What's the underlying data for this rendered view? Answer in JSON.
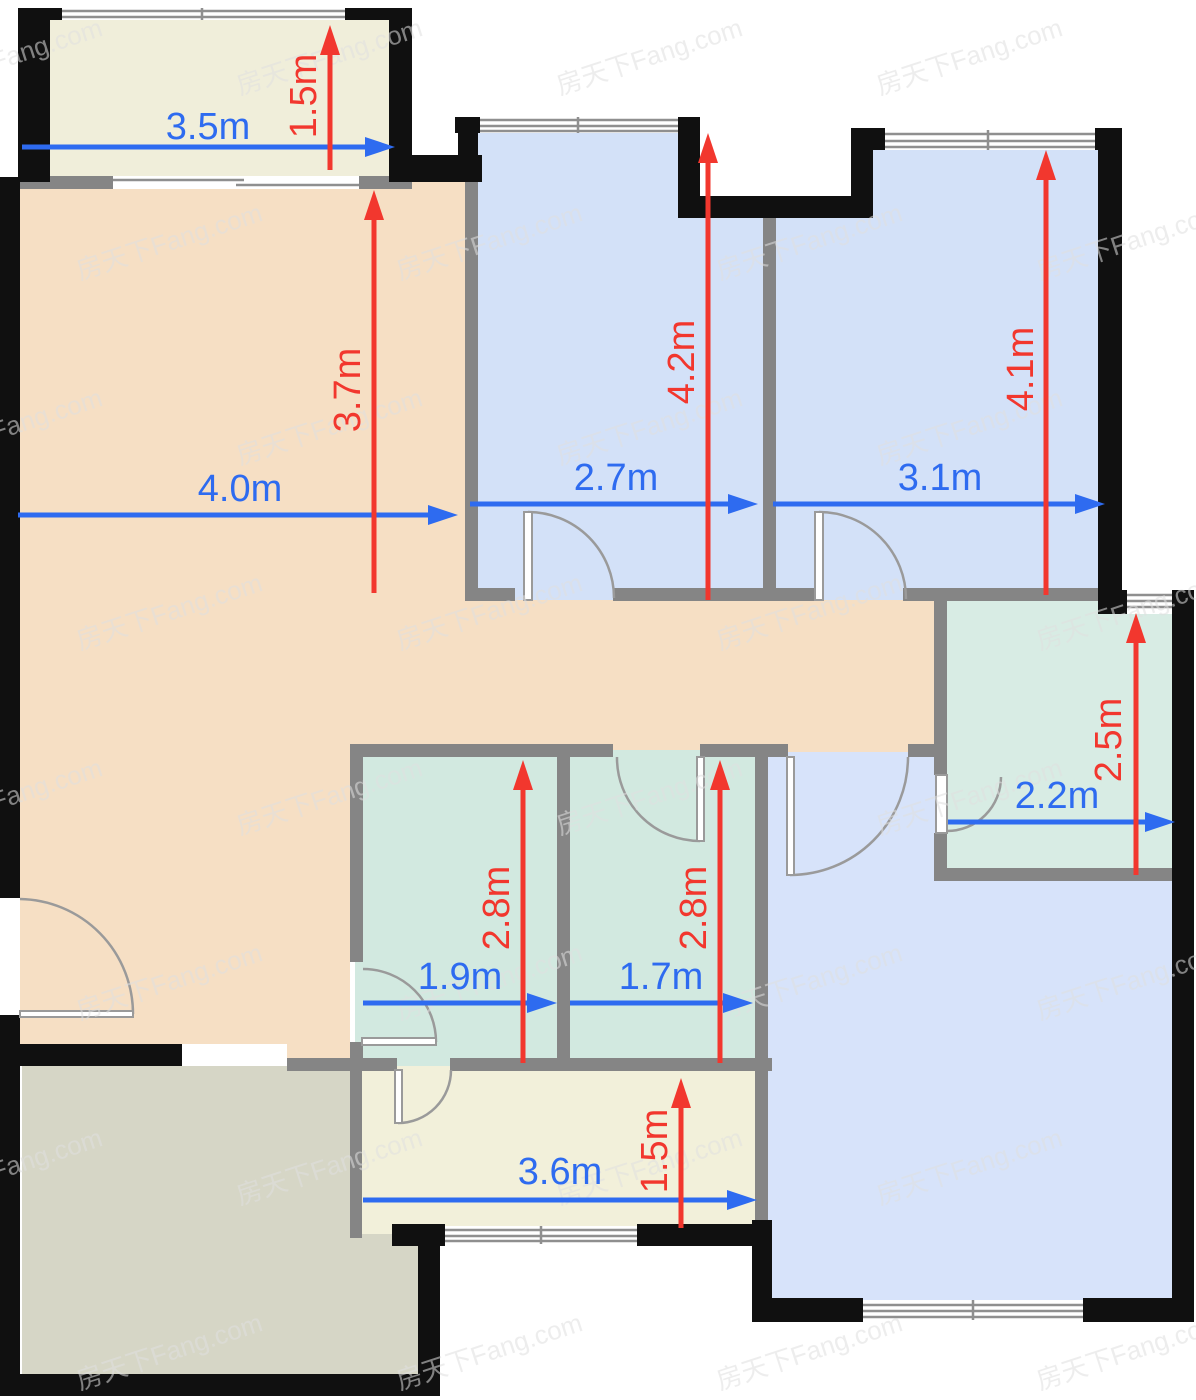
{
  "watermark": {
    "text": "房天下Fang.com"
  },
  "palette": {
    "wall_black": "#101010",
    "wall_gray": "#858585",
    "balcony": "#f0eeda",
    "living": "#f6dfc4",
    "bedroom_blue": "#d3e1f8",
    "bedroom_blue2": "#d7e3fa",
    "bath_teal": "#d2e9e0",
    "bath_teal2": "#d8ece4",
    "kitchen": "#f2f0da",
    "terrace": "#d6d6c6",
    "dim_blue": "#2e6bf0",
    "dim_red": "#f2372e",
    "door_stroke": "#9a9a9a",
    "window_line": "#8f8f8f",
    "watermark_fill": "#e0e0e0"
  },
  "rooms": [
    {
      "name": "balcony",
      "color": "balcony",
      "x": 18,
      "y": 12,
      "w": 392,
      "h": 170
    },
    {
      "name": "living-room-upper",
      "color": "living",
      "x": 20,
      "y": 177,
      "w": 445,
      "h": 423
    },
    {
      "name": "hallway",
      "color": "living",
      "x": 20,
      "y": 600,
      "w": 914,
      "h": 156
    },
    {
      "name": "living-room-lower",
      "color": "living",
      "x": 20,
      "y": 756,
      "w": 330,
      "h": 310
    },
    {
      "name": "bedroom-top-middle",
      "color": "bedroom_blue",
      "x": 478,
      "y": 125,
      "w": 285,
      "h": 475
    },
    {
      "name": "bedroom-top-right",
      "color": "bedroom_blue",
      "x": 776,
      "y": 140,
      "w": 322,
      "h": 460
    },
    {
      "name": "bedroom-bottom-right",
      "color": "bedroom_blue2",
      "x": 767,
      "y": 752,
      "w": 413,
      "h": 552
    },
    {
      "name": "bathroom-right",
      "color": "bath_teal2",
      "x": 940,
      "y": 600,
      "w": 240,
      "h": 275
    },
    {
      "name": "bathroom-left",
      "color": "bath_teal",
      "x": 355,
      "y": 750,
      "w": 208,
      "h": 316
    },
    {
      "name": "bathroom-middle",
      "color": "bath_teal",
      "x": 563,
      "y": 750,
      "w": 199,
      "h": 316
    },
    {
      "name": "kitchen",
      "color": "kitchen",
      "x": 355,
      "y": 1066,
      "w": 407,
      "h": 168
    },
    {
      "name": "terrace-upper",
      "color": "terrace",
      "x": 22,
      "y": 1066,
      "w": 333,
      "h": 310
    },
    {
      "name": "terrace-lower",
      "color": "terrace",
      "x": 355,
      "y": 1234,
      "w": 75,
      "h": 142
    }
  ],
  "white_patches": [
    {
      "name": "exterior-notch",
      "x": 678,
      "y": 60,
      "w": 195,
      "h": 136
    },
    {
      "name": "living-terrace-opening",
      "x": 182,
      "y": 1044,
      "w": 105,
      "h": 22
    }
  ],
  "walls_black": [
    {
      "x": 18,
      "y": 8,
      "w": 44,
      "h": 12
    },
    {
      "x": 345,
      "y": 8,
      "w": 67,
      "h": 12
    },
    {
      "x": 18,
      "y": 8,
      "w": 32,
      "h": 174
    },
    {
      "x": 389,
      "y": 8,
      "w": 23,
      "h": 150
    },
    {
      "x": 389,
      "y": 155,
      "w": 93,
      "h": 27
    },
    {
      "x": 0,
      "y": 177,
      "w": 20,
      "h": 721
    },
    {
      "x": 0,
      "y": 1015,
      "w": 20,
      "h": 381
    },
    {
      "x": 0,
      "y": 1374,
      "w": 440,
      "h": 22
    },
    {
      "x": 418,
      "y": 1234,
      "w": 22,
      "h": 162
    },
    {
      "x": 0,
      "y": 1044,
      "w": 182,
      "h": 22
    },
    {
      "x": 455,
      "y": 117,
      "w": 25,
      "h": 16
    },
    {
      "x": 458,
      "y": 117,
      "w": 20,
      "h": 65
    },
    {
      "x": 678,
      "y": 117,
      "w": 22,
      "h": 101
    },
    {
      "x": 678,
      "y": 196,
      "w": 195,
      "h": 22
    },
    {
      "x": 851,
      "y": 128,
      "w": 22,
      "h": 90
    },
    {
      "x": 851,
      "y": 128,
      "w": 34,
      "h": 22
    },
    {
      "x": 1095,
      "y": 128,
      "w": 27,
      "h": 22
    },
    {
      "x": 1098,
      "y": 128,
      "w": 24,
      "h": 476
    },
    {
      "x": 1098,
      "y": 590,
      "w": 31,
      "h": 24
    },
    {
      "x": 1170,
      "y": 590,
      "w": 24,
      "h": 24
    },
    {
      "x": 1172,
      "y": 600,
      "w": 22,
      "h": 722
    },
    {
      "x": 752,
      "y": 1298,
      "w": 111,
      "h": 24
    },
    {
      "x": 1083,
      "y": 1298,
      "w": 111,
      "h": 24
    },
    {
      "x": 752,
      "y": 1220,
      "w": 20,
      "h": 102
    },
    {
      "x": 392,
      "y": 1224,
      "w": 53,
      "h": 22
    },
    {
      "x": 637,
      "y": 1224,
      "w": 135,
      "h": 22
    }
  ],
  "walls_gray": [
    {
      "x": 20,
      "y": 176,
      "w": 95,
      "h": 13
    },
    {
      "x": 357,
      "y": 176,
      "w": 55,
      "h": 13
    },
    {
      "x": 465,
      "y": 180,
      "w": 13,
      "h": 420
    },
    {
      "x": 465,
      "y": 588,
      "w": 50,
      "h": 13
    },
    {
      "x": 613,
      "y": 588,
      "w": 204,
      "h": 13
    },
    {
      "x": 903,
      "y": 588,
      "w": 195,
      "h": 13
    },
    {
      "x": 763,
      "y": 196,
      "w": 13,
      "h": 404
    },
    {
      "x": 934,
      "y": 600,
      "w": 13,
      "h": 175
    },
    {
      "x": 934,
      "y": 833,
      "w": 13,
      "h": 47
    },
    {
      "x": 934,
      "y": 868,
      "w": 246,
      "h": 13
    },
    {
      "x": 350,
      "y": 744,
      "w": 263,
      "h": 13
    },
    {
      "x": 700,
      "y": 744,
      "w": 67,
      "h": 13
    },
    {
      "x": 767,
      "y": 744,
      "w": 21,
      "h": 13
    },
    {
      "x": 908,
      "y": 744,
      "w": 32,
      "h": 13
    },
    {
      "x": 350,
      "y": 744,
      "w": 13,
      "h": 218
    },
    {
      "x": 350,
      "y": 1042,
      "w": 13,
      "h": 24
    },
    {
      "x": 557,
      "y": 750,
      "w": 13,
      "h": 316
    },
    {
      "x": 755,
      "y": 750,
      "w": 13,
      "h": 470
    },
    {
      "x": 287,
      "y": 1058,
      "w": 110,
      "h": 13
    },
    {
      "x": 450,
      "y": 1058,
      "w": 322,
      "h": 13
    },
    {
      "x": 350,
      "y": 1058,
      "w": 12,
      "h": 180
    }
  ],
  "windows": [
    {
      "name": "balcony-window",
      "base": {
        "x": 62,
        "y": 8,
        "w": 283,
        "h": 12
      },
      "lines": [
        [
          62,
          11,
          345,
          11
        ],
        [
          62,
          17,
          345,
          17
        ],
        [
          202,
          8,
          202,
          20
        ]
      ]
    },
    {
      "name": "bedroom-top-middle-window",
      "base": {
        "x": 480,
        "y": 117,
        "w": 198,
        "h": 16
      },
      "lines": [
        [
          480,
          120,
          678,
          120
        ],
        [
          480,
          126,
          678,
          126
        ],
        [
          480,
          131,
          678,
          131
        ],
        [
          578,
          117,
          578,
          133
        ]
      ]
    },
    {
      "name": "bedroom-top-right-window",
      "base": {
        "x": 885,
        "y": 130,
        "w": 210,
        "h": 20
      },
      "lines": [
        [
          885,
          134,
          1095,
          134
        ],
        [
          885,
          141,
          1095,
          141
        ],
        [
          885,
          147,
          1095,
          147
        ],
        [
          988,
          130,
          988,
          150
        ]
      ]
    },
    {
      "name": "bathroom-right-window",
      "base": {
        "x": 1127,
        "y": 590,
        "w": 45,
        "h": 24
      },
      "lines": [
        [
          1127,
          595,
          1172,
          595
        ],
        [
          1127,
          601,
          1172,
          601
        ],
        [
          1127,
          607,
          1172,
          607
        ]
      ]
    },
    {
      "name": "kitchen-window",
      "base": {
        "x": 445,
        "y": 1226,
        "w": 192,
        "h": 18
      },
      "lines": [
        [
          445,
          1230,
          637,
          1230
        ],
        [
          445,
          1236,
          637,
          1236
        ],
        [
          445,
          1241,
          637,
          1241
        ],
        [
          541,
          1226,
          541,
          1244
        ]
      ]
    },
    {
      "name": "bedroom-bottom-right-window",
      "base": {
        "x": 863,
        "y": 1300,
        "w": 220,
        "h": 20
      },
      "lines": [
        [
          863,
          1305,
          1083,
          1305
        ],
        [
          863,
          1311,
          1083,
          1311
        ],
        [
          863,
          1317,
          1083,
          1317
        ],
        [
          973,
          1300,
          973,
          1320
        ]
      ]
    },
    {
      "name": "balcony-sliding-door",
      "base": {
        "x": 113,
        "y": 176,
        "w": 246,
        "h": 13
      },
      "lines": [
        [
          113,
          180,
          244,
          180
        ],
        [
          236,
          185,
          359,
          185
        ]
      ]
    }
  ],
  "doors": [
    {
      "name": "entry-door",
      "leaf": {
        "x": 20,
        "y": 1011,
        "w": 113,
        "h": 6
      },
      "arc": "M 20 899 A 115 115 0 0 1 133 1014"
    },
    {
      "name": "bedroom-top-middle-door",
      "leaf": {
        "x": 524,
        "y": 512,
        "w": 8,
        "h": 88
      },
      "arc": "M 528 512 A 86 86 0 0 1 614 598"
    },
    {
      "name": "bedroom-top-right-door",
      "leaf": {
        "x": 815,
        "y": 512,
        "w": 8,
        "h": 88
      },
      "arc": "M 819 512 A 87 87 0 0 1 906 599"
    },
    {
      "name": "bathroom-right-door",
      "leaf": {
        "x": 936,
        "y": 775,
        "w": 11,
        "h": 58
      },
      "arc": "M 1001 777 A 54 54 0 0 1 947 831"
    },
    {
      "name": "bathroom-left-door",
      "leaf": {
        "x": 362,
        "y": 1038,
        "w": 74,
        "h": 7
      },
      "arc": "M 363 969 A 73 73 0 0 1 436 1042"
    },
    {
      "name": "bathroom-middle-door",
      "leaf": {
        "x": 697,
        "y": 757,
        "w": 7,
        "h": 84
      },
      "arc": "M 617 757 A 83 83 0 0 0 700 841"
    },
    {
      "name": "bedroom-bottom-right-door",
      "leaf": {
        "x": 787,
        "y": 757,
        "w": 7,
        "h": 118
      },
      "arc": "M 790 875 A 118 118 0 0 0 908 757"
    },
    {
      "name": "kitchen-door",
      "leaf": {
        "x": 395,
        "y": 1070,
        "w": 7,
        "h": 53
      },
      "arc": "M 398 1123 A 53 53 0 0 0 451 1070"
    }
  ],
  "dimensions": [
    {
      "id": "balcony-width",
      "label": "3.5m",
      "color": "blue",
      "orient": "h",
      "x1": 22,
      "x2": 395,
      "y": 147,
      "lx": 208,
      "ly": 127
    },
    {
      "id": "balcony-depth",
      "label": "1.5m",
      "color": "red",
      "orient": "v",
      "x": 330,
      "y1": 170,
      "y2": 25,
      "lx": 304,
      "ly": 96
    },
    {
      "id": "living-width",
      "label": "4.0m",
      "color": "blue",
      "orient": "h",
      "x1": 18,
      "x2": 458,
      "y": 515,
      "lx": 240,
      "ly": 489
    },
    {
      "id": "living-depth",
      "label": "3.7m",
      "color": "red",
      "orient": "v",
      "x": 374,
      "y1": 593,
      "y2": 190,
      "lx": 348,
      "ly": 390
    },
    {
      "id": "bedroom-top-middle-width",
      "label": "2.7m",
      "color": "blue",
      "orient": "h",
      "x1": 470,
      "x2": 758,
      "y": 504,
      "lx": 616,
      "ly": 478
    },
    {
      "id": "bedroom-top-middle-depth",
      "label": "4.2m",
      "color": "red",
      "orient": "v",
      "x": 708,
      "y1": 600,
      "y2": 133,
      "lx": 682,
      "ly": 362
    },
    {
      "id": "bedroom-top-right-width",
      "label": "3.1m",
      "color": "blue",
      "orient": "h",
      "x1": 773,
      "x2": 1105,
      "y": 504,
      "lx": 940,
      "ly": 478
    },
    {
      "id": "bedroom-top-right-depth",
      "label": "4.1m",
      "color": "red",
      "orient": "v",
      "x": 1046,
      "y1": 595,
      "y2": 150,
      "lx": 1021,
      "ly": 369
    },
    {
      "id": "bathroom-right-width",
      "label": "2.2m",
      "color": "blue",
      "orient": "h",
      "x1": 948,
      "x2": 1175,
      "y": 822,
      "lx": 1057,
      "ly": 796
    },
    {
      "id": "bathroom-right-depth",
      "label": "2.5m",
      "color": "red",
      "orient": "v",
      "x": 1136,
      "y1": 875,
      "y2": 613,
      "lx": 1109,
      "ly": 740
    },
    {
      "id": "bathroom-left-width",
      "label": "1.9m",
      "color": "blue",
      "orient": "h",
      "x1": 363,
      "x2": 557,
      "y": 1003,
      "lx": 460,
      "ly": 977
    },
    {
      "id": "bathroom-left-depth",
      "label": "2.8m",
      "color": "red",
      "orient": "v",
      "x": 523,
      "y1": 1063,
      "y2": 760,
      "lx": 497,
      "ly": 908
    },
    {
      "id": "bathroom-middle-width",
      "label": "1.7m",
      "color": "blue",
      "orient": "h",
      "x1": 570,
      "x2": 753,
      "y": 1003,
      "lx": 661,
      "ly": 977
    },
    {
      "id": "bathroom-middle-depth",
      "label": "2.8m",
      "color": "red",
      "orient": "v",
      "x": 720,
      "y1": 1063,
      "y2": 760,
      "lx": 694,
      "ly": 908
    },
    {
      "id": "kitchen-width",
      "label": "3.6m",
      "color": "blue",
      "orient": "h",
      "x1": 363,
      "x2": 757,
      "y": 1200,
      "lx": 560,
      "ly": 1172
    },
    {
      "id": "kitchen-depth",
      "label": "1.5m",
      "color": "red",
      "orient": "v",
      "x": 681,
      "y1": 1228,
      "y2": 1078,
      "lx": 655,
      "ly": 1151
    }
  ],
  "dim_style": {
    "font_size": 38,
    "line_width": 5,
    "head_len": 30,
    "head_half": 10
  }
}
